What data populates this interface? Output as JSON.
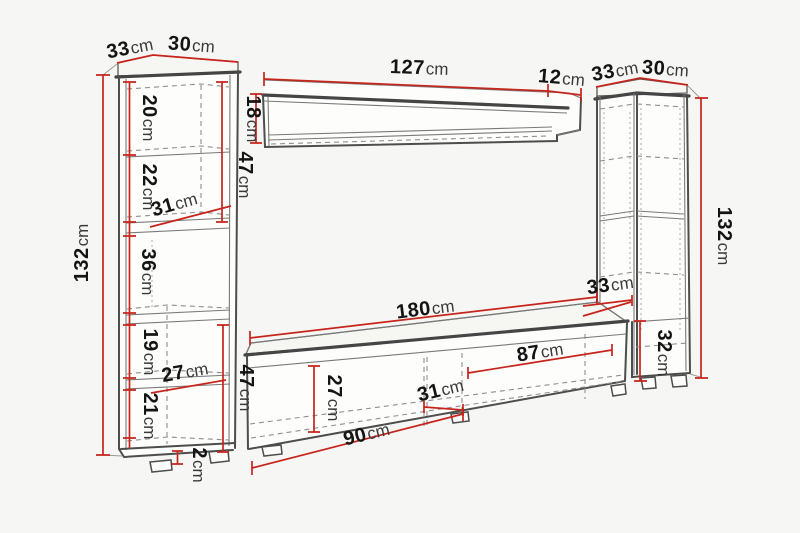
{
  "diagram": {
    "unit": "cm",
    "colors": {
      "background": "#f6f6f4",
      "outline": "#4d4d4d",
      "dimension_line": "#c7241b",
      "label_number": "#141414",
      "label_unit": "#3a3a3a"
    },
    "left_cabinet": {
      "top_depth": "33",
      "top_width": "30",
      "height": "132",
      "section_1": "20",
      "section_2": "22",
      "section_3": "36",
      "section_4": "19",
      "section_5": "21",
      "upper_section_height": "47",
      "lower_section_height": "47",
      "inner_width_upper": "31",
      "inner_width_lower": "27",
      "plinth_height": "2"
    },
    "wall_shelf": {
      "width": "127",
      "depth": "12",
      "height": "18"
    },
    "right_cabinet": {
      "top_depth": "33",
      "top_width": "30",
      "height": "132",
      "lower_depth": "33",
      "lower_section_height": "32"
    },
    "tv_stand": {
      "width": "180",
      "left_compartment_width": "90",
      "right_compartment_width": "87",
      "front_height": "27",
      "middle_width": "31"
    }
  }
}
